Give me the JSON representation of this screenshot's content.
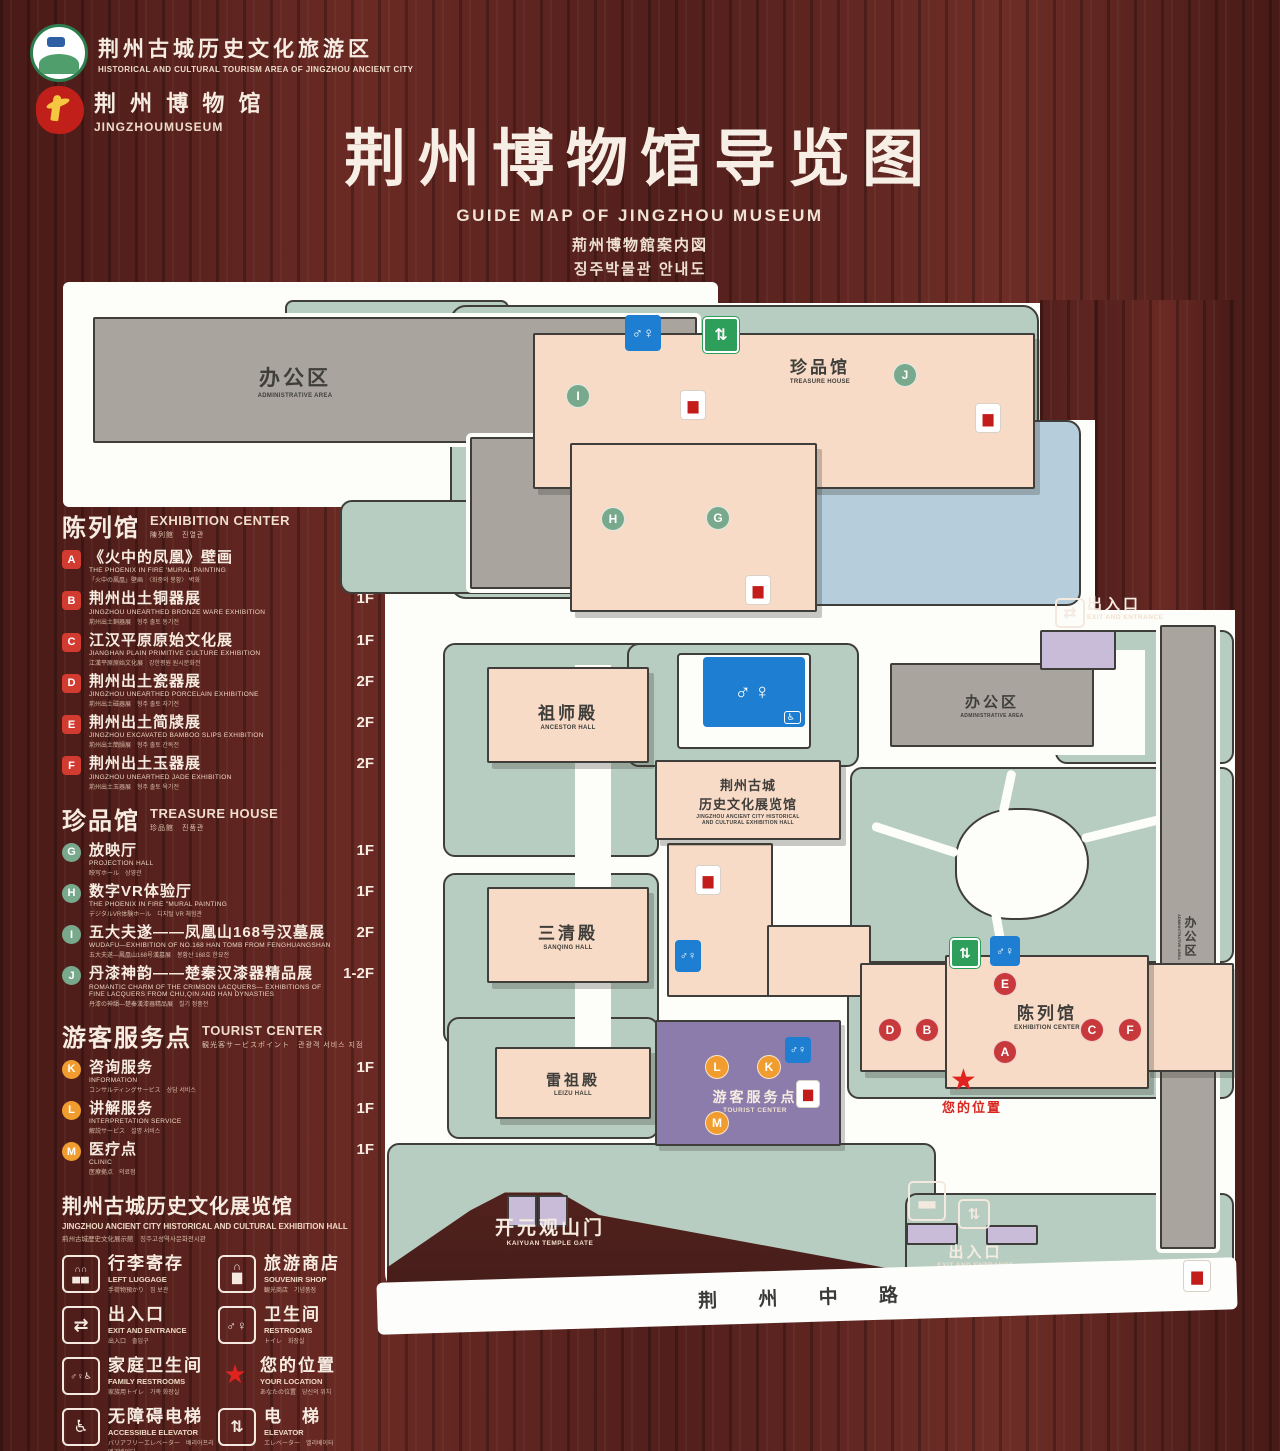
{
  "header": {
    "logo1": {
      "zh": "荆州古城历史文化旅游区",
      "en": "HISTORICAL AND CULTURAL TOURISM AREA OF JINGZHOU ANCIENT CITY"
    },
    "logo2": {
      "zh": "荆 州 博 物 馆",
      "en": "JINGZHOUMUSEUM"
    },
    "title_zh": "荆州博物馆导览图",
    "title_en": "GUIDE MAP OF JINGZHOU MUSEUM",
    "title_jp": "荊州博物館案内図",
    "title_kr": "징주박물관 안내도"
  },
  "colors": {
    "wood": "#5c2320",
    "lawn": "#b7cdc1",
    "pink": "#f8dbc7",
    "gray": "#a9a59e",
    "pond": "#b6cedb",
    "purple": "#8c7cab",
    "restroom_blue": "#1e7fd2",
    "elevator_green": "#2e9e5b",
    "marker_red": "#c8393b",
    "marker_green": "#79a98c",
    "marker_orange": "#f09c2e",
    "star_red": "#e0231e"
  },
  "legend": {
    "sections": [
      {
        "zh": "陈列馆",
        "en": "EXHIBITION CENTER",
        "sub": "陳列館　진열관",
        "items": [
          {
            "letter": "A",
            "zh": "《火中的凤凰》壁画",
            "en": "THE PHOENIX IN FIRE 'MURAL PAINTING",
            "sub": "「火中の鳳凰」壁画　〈화중의 봉황〉 벽화",
            "floor": "1F"
          },
          {
            "letter": "B",
            "zh": "荆州出土铜器展",
            "en": "JINGZHOU UNEARTHED BRONZE WARE EXHIBITION",
            "sub": "荊州出土銅器展　형주 출토 동기전",
            "floor": "1F"
          },
          {
            "letter": "C",
            "zh": "江汉平原原始文化展",
            "en": "JIANGHAN PLAIN PRIMITIVE CULTURE EXHIBITION",
            "sub": "江漢平原原始文化展　강한평원 원시문화전",
            "floor": "1F"
          },
          {
            "letter": "D",
            "zh": "荆州出土瓷器展",
            "en": "JINGZHOU UNEARTHED PORCELAIN EXHIBITIONE",
            "sub": "荊州出土磁器展　형주 출토 자기전",
            "floor": "2F"
          },
          {
            "letter": "E",
            "zh": "荆州出土简牍展",
            "en": "JINGZHOU EXCAVATED BAMBOO SLIPS EXHIBITION",
            "sub": "荊州出土簡牘展　형주 출토 간독전",
            "floor": "2F"
          },
          {
            "letter": "F",
            "zh": "荆州出土玉器展",
            "en": "JINGZHOU UNEARTHED JADE EXHIBITION",
            "sub": "荊州出土玉器展　형주 출토 옥기전",
            "floor": "2F"
          }
        ]
      },
      {
        "zh": "珍品馆",
        "en": "TREASURE HOUSE",
        "sub": "珍品館　진품관",
        "items": [
          {
            "letter": "G",
            "zh": "放映厅",
            "en": "PROJECTION HALL",
            "sub": "映写ホール　상영관",
            "floor": "1F"
          },
          {
            "letter": "H",
            "zh": "数字VR体验厅",
            "en": "THE PHOENIX IN FIRE \"MURAL PAINTING",
            "sub": "デジタルVR体験ホール　디지털 VR 체험관",
            "floor": "1F"
          },
          {
            "letter": "I",
            "zh": "五大夫遂——凤凰山168号汉墓展",
            "en": "WUDAFU—EXHIBITION OF NO.168 HAN TOMB FROM FENGHUANGSHAN",
            "sub": "五大夫遂—鳳凰山168号漢墓展　봉황산 168호 한묘전",
            "floor": "2F"
          },
          {
            "letter": "J",
            "zh": "丹漆神韵——楚秦汉漆器精品展",
            "en": "ROMANTIC CHARM OF THE CRIMSON LACQUERS— EXHIBITIONS OF FINE LACQUERS FROM CHU,QIN AND HAN DYNASTIES",
            "sub": "丹漆の神韻—楚秦漢漆器精品展　칠기 정품전",
            "floor": "1-2F"
          }
        ]
      },
      {
        "zh": "游客服务点",
        "en": "TOURIST CENTER",
        "sub": "観光客サービスポイント　관광객 서비스 지점",
        "items": [
          {
            "letter": "K",
            "zh": "咨询服务",
            "en": "INFORMATION",
            "sub": "コンサルティングサービス　상담 서비스",
            "floor": "1F"
          },
          {
            "letter": "L",
            "zh": "讲解服务",
            "en": "INTERPRETATION SERVICE",
            "sub": "解説サービス　설명 서비스",
            "floor": "1F"
          },
          {
            "letter": "M",
            "zh": "医疗点",
            "en": "CLINIC",
            "sub": "医療拠点　의료점",
            "floor": "1F"
          }
        ]
      }
    ],
    "hall_title": {
      "zh": "荆州古城历史文化展览馆",
      "en": "JINGZHOU ANCIENT CITY HISTORICAL AND CULTURAL EXHIBITION HALL",
      "sub": "荊州古城歴史文化展示館　징주고성역사문화전시관"
    },
    "facilities": [
      {
        "icon": "luggage",
        "zh": "行李寄存",
        "en": "LEFT LUGGAGE",
        "sub": "手荷物預かり　짐 보관"
      },
      {
        "icon": "shop",
        "zh": "旅游商店",
        "en": "SOUVENIR SHOP",
        "sub": "観光商店　기념품점"
      },
      {
        "icon": "exit",
        "zh": "出入口",
        "en": "EXIT AND ENTRANCE",
        "sub": "出入口　출입구"
      },
      {
        "icon": "restroom",
        "zh": "卫生间",
        "en": "RESTROOMS",
        "sub": "トイレ　화장실"
      },
      {
        "icon": "family",
        "zh": "家庭卫生间",
        "en": "FAMILY RESTROOMS",
        "sub": "家族用トイレ　가족 화장실"
      },
      {
        "icon": "star",
        "zh": "您的位置",
        "en": "YOUR LOCATION",
        "sub": "あなたの位置　당신의 위치"
      },
      {
        "icon": "accessible-elevator",
        "zh": "无障碍电梯",
        "en": "ACCESSIBLE ELEVATOR",
        "sub": "バリアフリーエレベーター　배리어프리 엘리베이터"
      },
      {
        "icon": "elevator",
        "zh": "电　梯",
        "en": "ELEVATOR",
        "sub": "エレベーター　엘리베이터"
      },
      {
        "icon": "display-swatch",
        "zh": "展示区域",
        "en": "DISPLAY AREA",
        "sub": "展示エリア　전시 영역"
      },
      {
        "icon": "office-swatch",
        "zh": "办公区域",
        "en": "OFFICE AREA",
        "sub": "オフィスエリア　사무실 구역"
      }
    ]
  },
  "map": {
    "labels": {
      "admin_top_zh": "办公区",
      "admin_top_en": "ADMINISTRATIVE AREA",
      "treasure_zh": "珍品馆",
      "treasure_en": "TREASURE HOUSE",
      "exit_top_zh": "出入口",
      "exit_top_en": "EXIT AND ENTRANCE",
      "admin_right_zh": "办公区",
      "admin_right_en": "ADMINISTRATIVE AREA",
      "admin_strip_zh": "办公区",
      "admin_strip_en": "ADMINISTRATIVE AREA",
      "ancestor_zh": "祖师殿",
      "ancestor_en": "ANCESTOR HALL",
      "historic_zh1": "荆州古城",
      "historic_zh2": "历史文化展览馆",
      "historic_en1": "JINGZHOU ANCIENT CITY HISTORICAL",
      "historic_en2": "AND CULTURAL EXHIBITION HALL",
      "sanqing_zh": "三清殿",
      "sanqing_en": "SANQING HALL",
      "leizu_zh": "雷祖殿",
      "leizu_en": "LEIZU HALL",
      "tourist_zh": "游客服务点",
      "tourist_en": "TOURIST CENTER",
      "exhibition_zh": "陈列馆",
      "exhibition_en": "EXHIBITION CENTER",
      "location_zh": "您的位置",
      "gate_zh": "开元观山门",
      "gate_en": "KAIYUAN TEMPLE GATE",
      "exit_bottom_zh": "出入口",
      "exit_bottom_en": "EXIT AND ENTRANCE",
      "road_zh": "荆 州 中 路"
    },
    "markers": {
      "a": "A",
      "b": "B",
      "c": "C",
      "d": "D",
      "e": "E",
      "f": "F",
      "g": "G",
      "h": "H",
      "i": "I",
      "j": "J",
      "k": "K",
      "l": "L",
      "m": "M"
    }
  }
}
